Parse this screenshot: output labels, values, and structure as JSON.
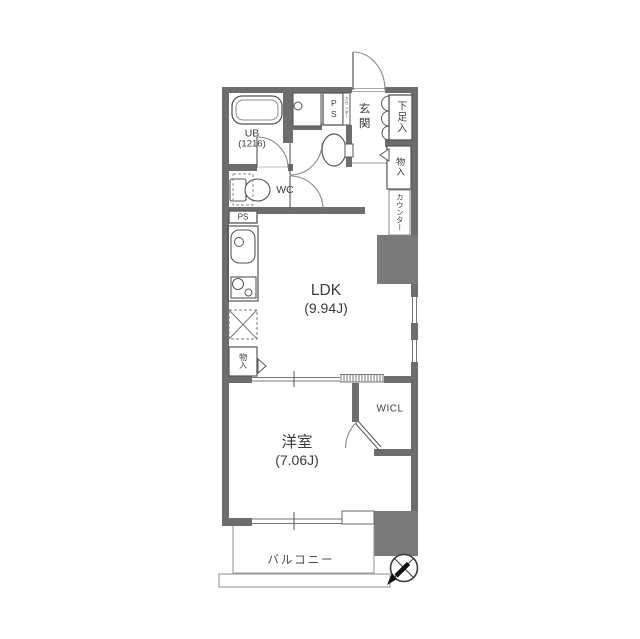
{
  "plan": {
    "rooms": {
      "ldk": {
        "name": "LDK",
        "size": "(9.94J)"
      },
      "western_room": {
        "name": "洋室",
        "size": "(7.06J)"
      },
      "unit_bath": {
        "name": "UB",
        "size": "(1216)"
      },
      "toilet": "WC",
      "entrance": "玄関",
      "shoe_box": "下足入",
      "storage_hall": "物入",
      "counter": "カウンター",
      "counter_small": "カウンター",
      "pipe_space_upper": "PS",
      "pipe_space_lower": "PS",
      "storage_kitchen": "物入",
      "walk_in_closet": "WICL",
      "balcony": "バルコニー"
    },
    "colors": {
      "wall": "#6d6d6d",
      "block": "#7a7a7a",
      "line": "#555555",
      "thin": "#999999",
      "arc": "#888888",
      "compass": "#3a3a3a"
    }
  }
}
